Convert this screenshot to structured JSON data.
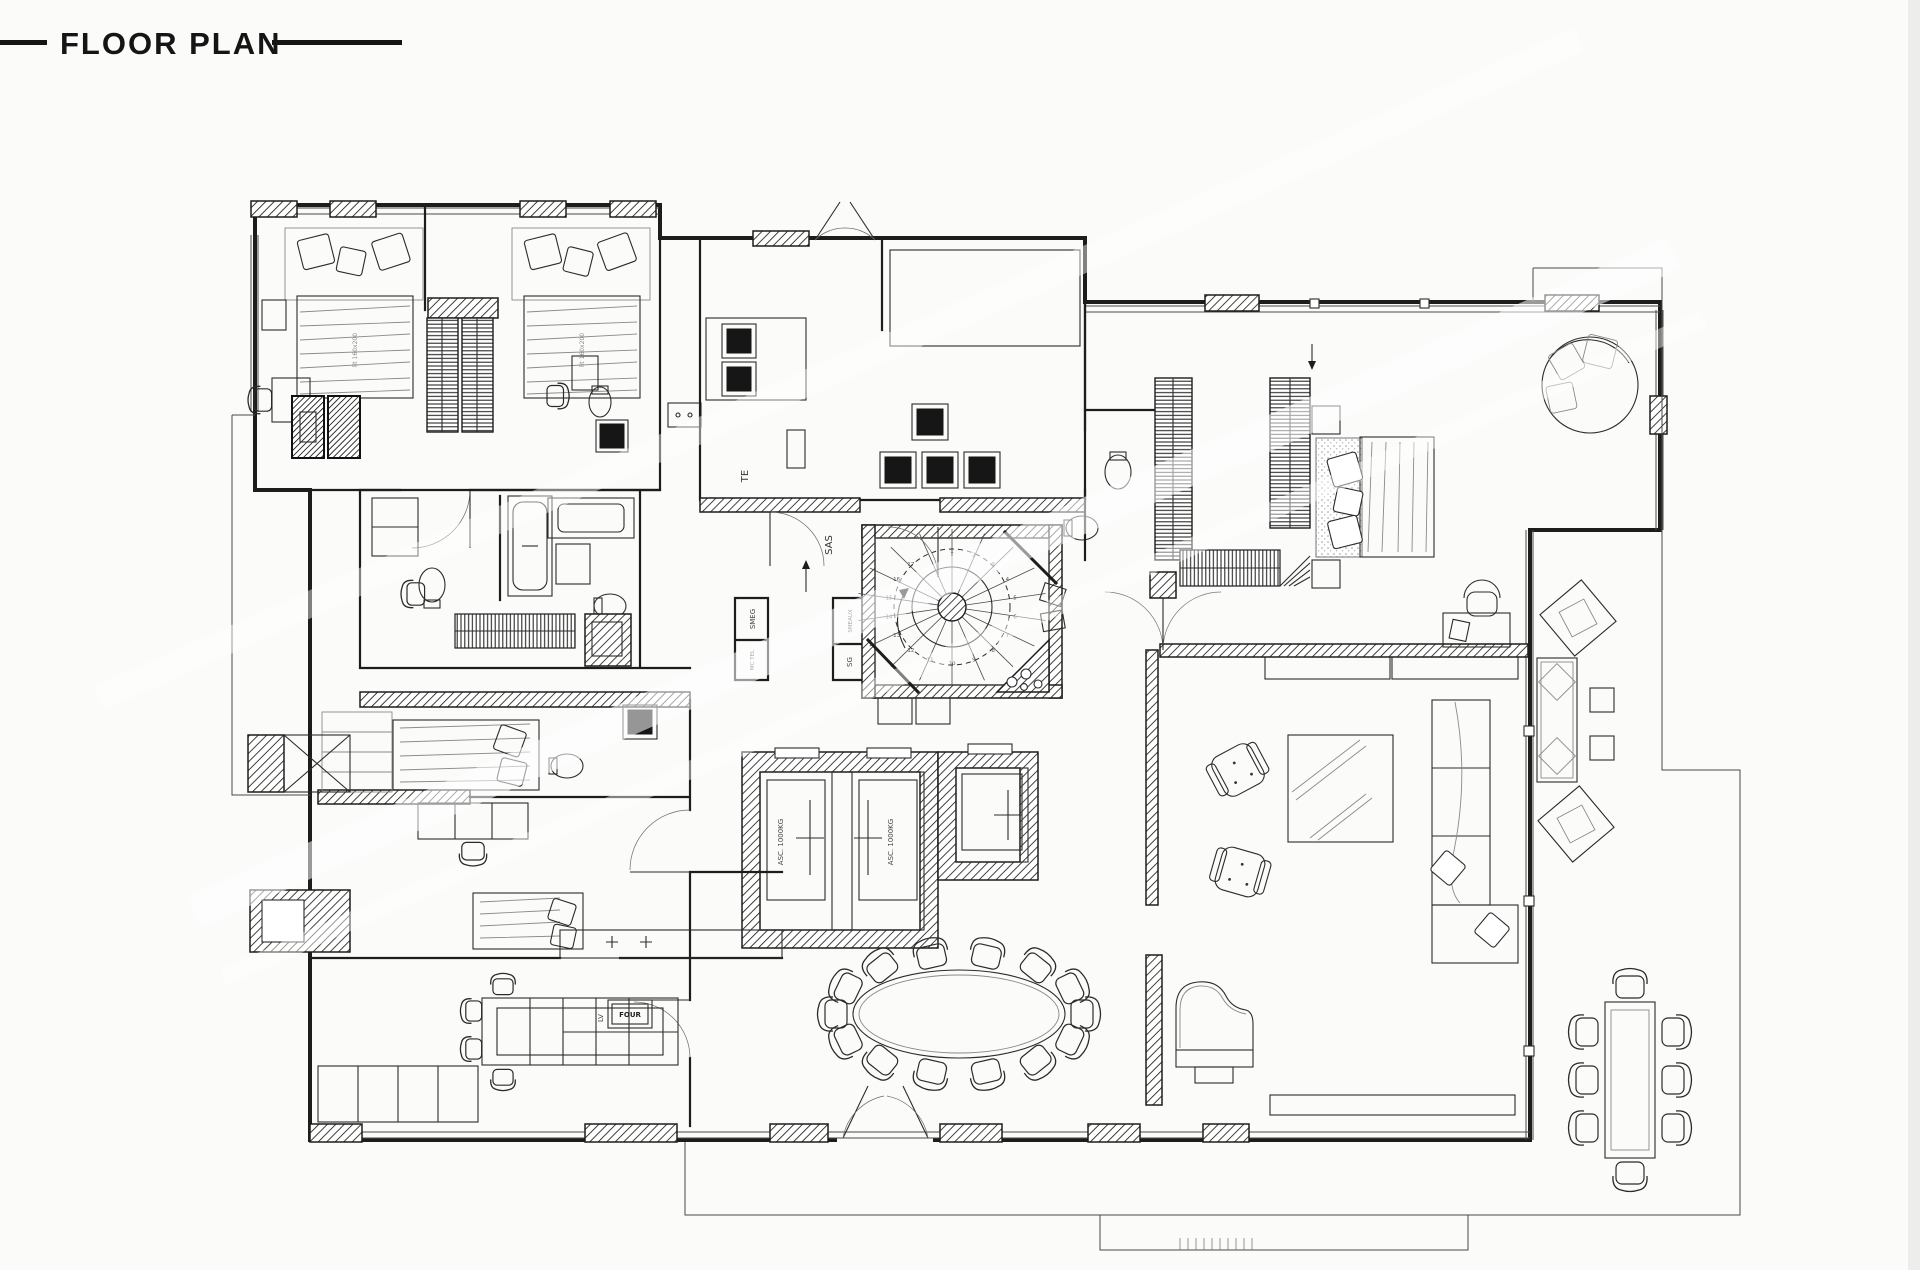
{
  "title": "FLOOR PLAN",
  "colors": {
    "ink": "#1d1d1b",
    "paper": "#fbfbfa",
    "muted": "#8a8a88"
  },
  "plan_labels": {
    "corridor": "TE",
    "entry_hall": "SAS",
    "shaft_1": "SMEG",
    "shaft_2": "MC TEL",
    "shaft_3": "SMEAUX",
    "shaft_4": "SG",
    "elevator_1": "ASC. 1000KG",
    "elevator_2": "ASC. 1000KG",
    "dishwasher": "LV",
    "oven": "FOUR",
    "bed_1": "lit 160x200",
    "bed_2": "lit 160x200"
  },
  "stair": {
    "step_numbers": [
      "1",
      "2",
      "3",
      "4",
      "5",
      "6",
      "7",
      "8",
      "9",
      "10",
      "11",
      "12",
      "13",
      "14",
      "15",
      "16",
      "17"
    ]
  },
  "seating": {
    "dining_seats": 14,
    "terrace_dining_seats": 8
  }
}
